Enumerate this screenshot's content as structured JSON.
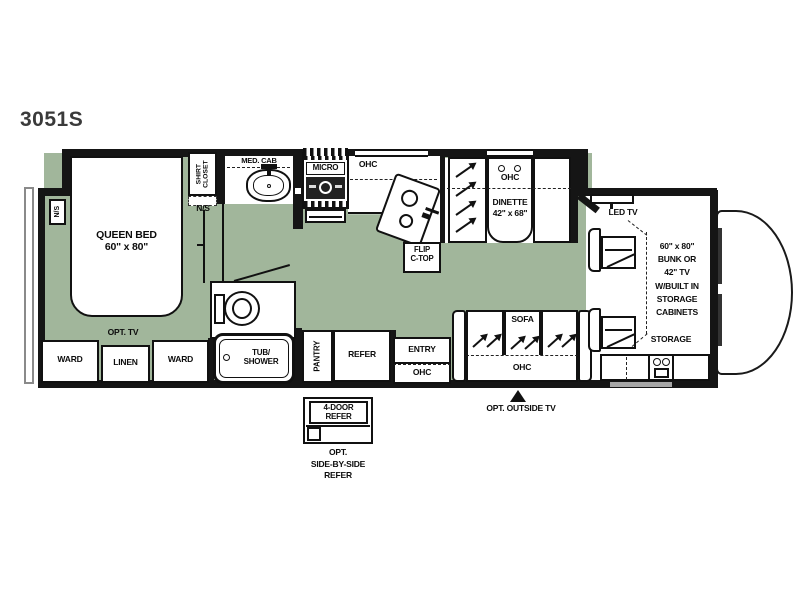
{
  "title": "3051S",
  "colors": {
    "floor": "#a1b69b",
    "wall": "#151515",
    "slide_outline": "#8a8a8a"
  },
  "bedroom": {
    "bed_line1": "QUEEN BED",
    "bed_line2": "60\" x 80\"",
    "nightstand_left": "N/S",
    "nightstand_right": "N/S",
    "shirt_closet": "SHIRT\nCLOSET",
    "opt_tv": "OPT. TV",
    "ward_left": "WARD",
    "linen": "LINEN",
    "ward_right": "WARD"
  },
  "bathroom": {
    "med_cab": "MED. CAB",
    "tub_shower": "TUB/\nSHOWER"
  },
  "kitchen": {
    "micro": "MICRO",
    "ohc": "OHC",
    "flip_ctop": "FLIP\nC-TOP",
    "pantry": "PANTRY",
    "refer": "REFER"
  },
  "dinette": {
    "ohc": "OHC",
    "name": "DINETTE",
    "size": "42\" x 68\""
  },
  "entry": {
    "label": "ENTRY",
    "ohc": "OHC"
  },
  "living": {
    "sofa": "SOFA",
    "ohc": "OHC",
    "opt_outside_tv": "OPT. OUTSIDE TV"
  },
  "front": {
    "led_tv": "LED TV",
    "bunk_lines": [
      "60\" x 80\"",
      "BUNK OR",
      "42\" TV",
      "W/BUILT IN",
      "STORAGE",
      "CABINETS"
    ],
    "storage": "STORAGE"
  },
  "options": {
    "four_door_refer": "4-DOOR\nREFER",
    "side_by_side": "OPT.\nSIDE-BY-SIDE\nREFER"
  }
}
